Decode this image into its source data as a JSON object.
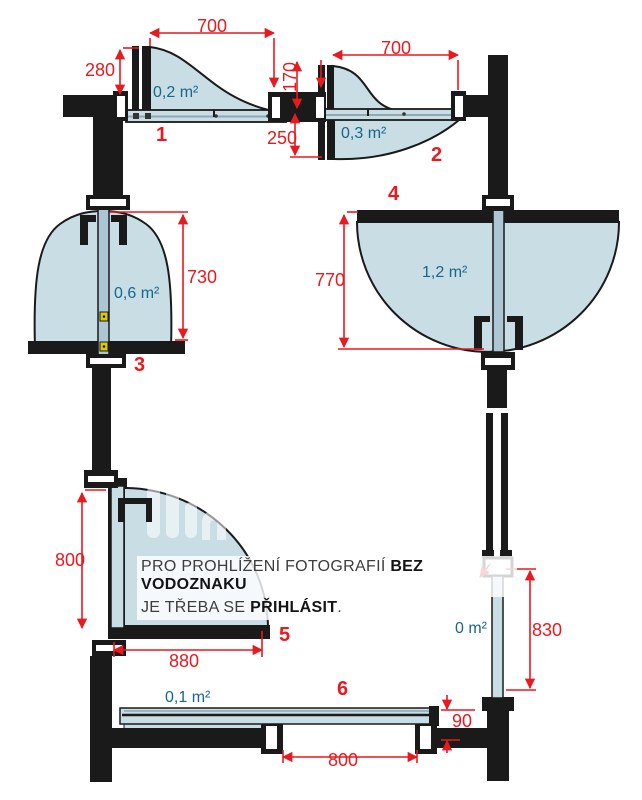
{
  "diagram_title": "roof-window-opening-types",
  "colors": {
    "dimension_red": "#e8191f",
    "area_teal": "#17678a",
    "glass_fill": "#c9dde5",
    "rail_fill": "#adc6d4",
    "structure_black": "#1a1a1a"
  },
  "windows": [
    {
      "number": "1",
      "area": "0,2 m²",
      "width": "700",
      "height": "280"
    },
    {
      "number": "2",
      "area": "0,3 m²",
      "width": "700",
      "top": "170",
      "bottom": "250"
    },
    {
      "number": "3",
      "area": "0,6 m²",
      "height": "730"
    },
    {
      "number": "4",
      "area": "1,2 m²",
      "height": "770"
    },
    {
      "number": "5",
      "area": "0,8 m²",
      "height": "800",
      "width": "880"
    },
    {
      "number": "6",
      "area": "0,1 m²",
      "width": "800",
      "lift": "90"
    }
  ],
  "fixed_panel": {
    "area": "0 m²",
    "height": "830"
  },
  "watermark": {
    "line1_regular": "PRO PROHLÍŽENÍ FOTOGRAFIÍ ",
    "line1_bold": "BEZ VODOZNAKU",
    "line2_regular": "JE TŘEBA SE ",
    "line2_bold": "PŘIHLÁSIT",
    "line2_suffix": "."
  }
}
